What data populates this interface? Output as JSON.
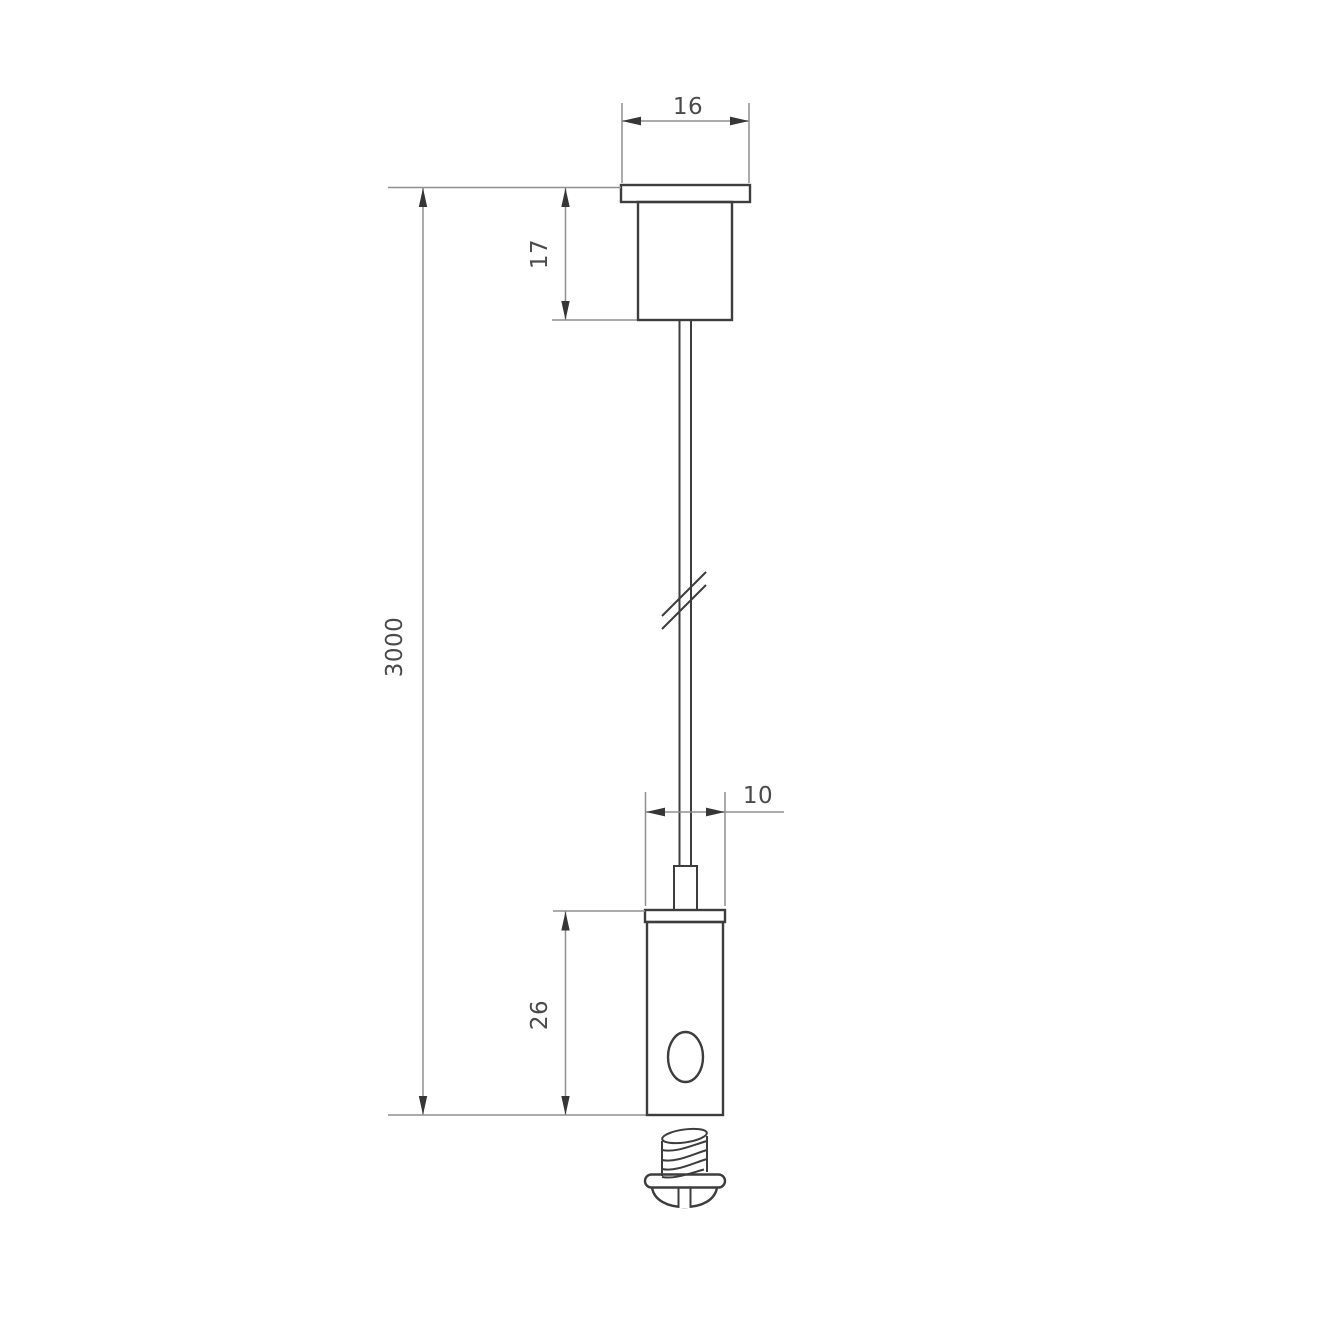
{
  "colors": {
    "background": "#ffffff",
    "object_line": "#3d3d3d",
    "dim_line": "#8f8f8f",
    "arrow_fill": "#363636",
    "dim_text": "#4a4a4a"
  },
  "dimensions": {
    "flange_width": "16",
    "mount_height": "17",
    "overall_length": "3000",
    "holder_diameter": "10",
    "holder_height": "26"
  }
}
